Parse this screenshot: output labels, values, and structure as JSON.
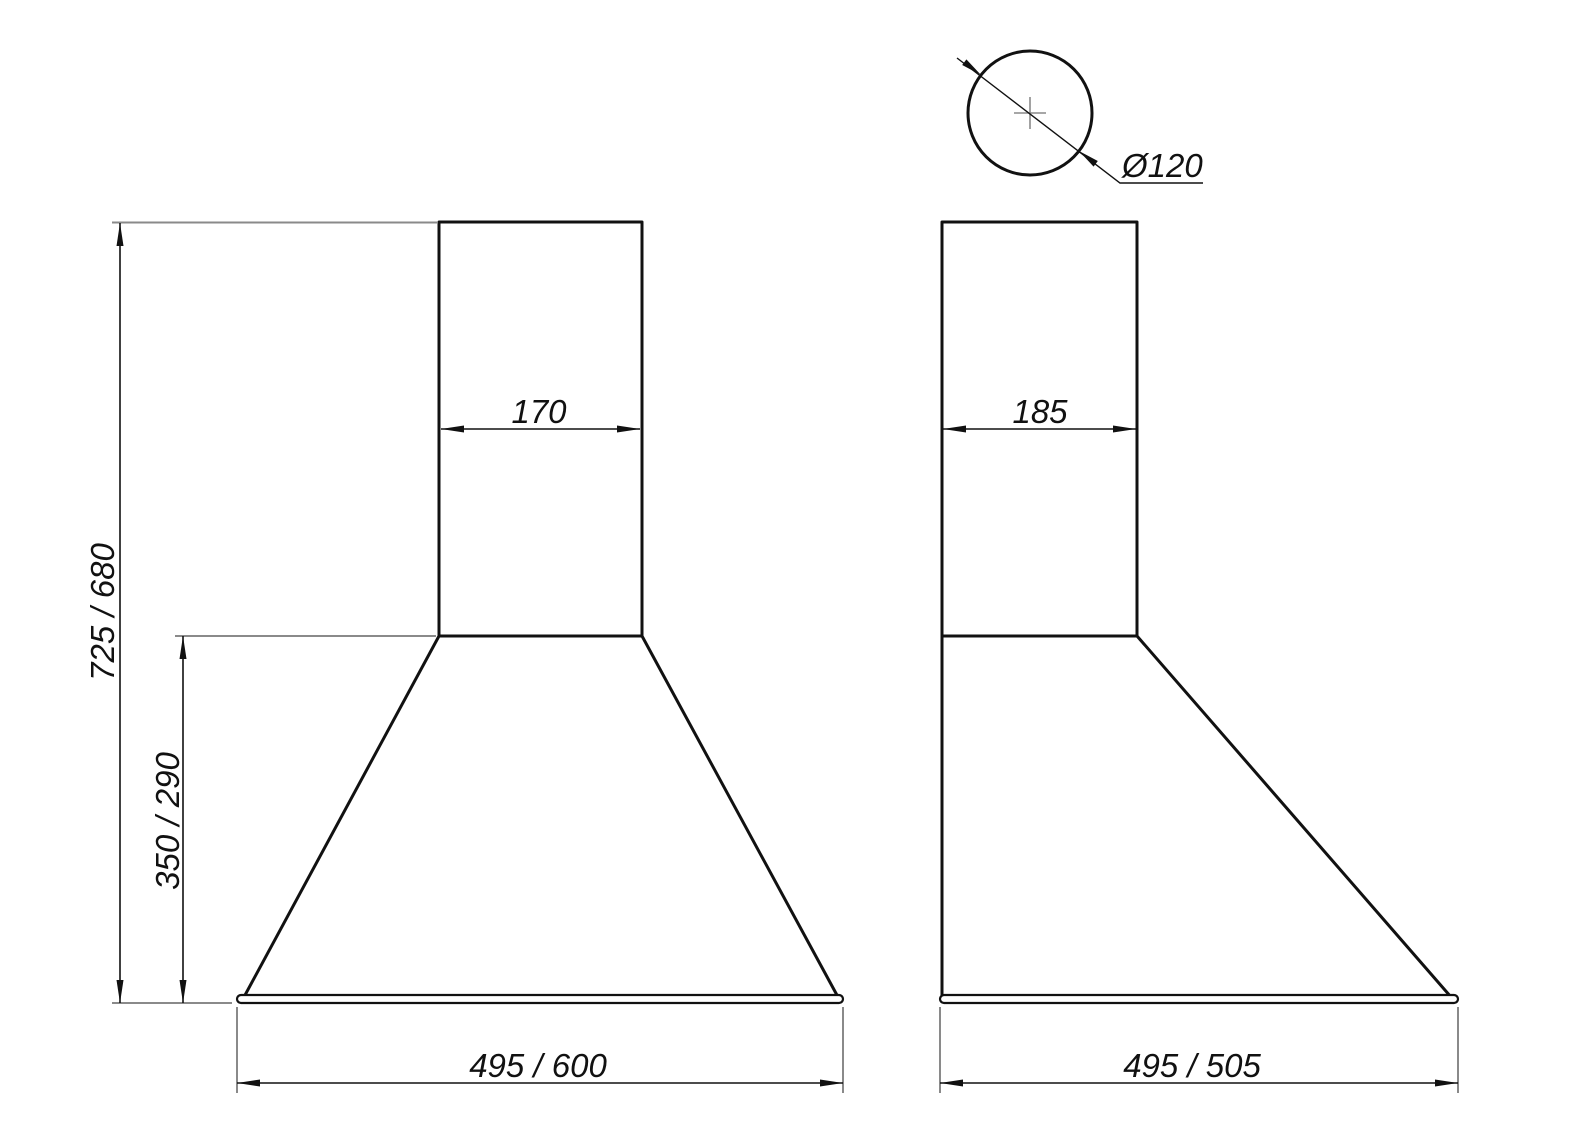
{
  "drawing": {
    "type": "technical-dimension-drawing",
    "colors": {
      "line": "#111111",
      "extension_line": "#8a8a8a",
      "background": "#ffffff"
    },
    "front_view": {
      "total_height": "725 / 680",
      "hood_height": "350 / 290",
      "chimney_width": "170",
      "base_width": "495 / 600"
    },
    "side_view": {
      "chimney_depth": "185",
      "base_depth": "495 / 505"
    },
    "outlet": {
      "diameter": "Ø120"
    }
  }
}
